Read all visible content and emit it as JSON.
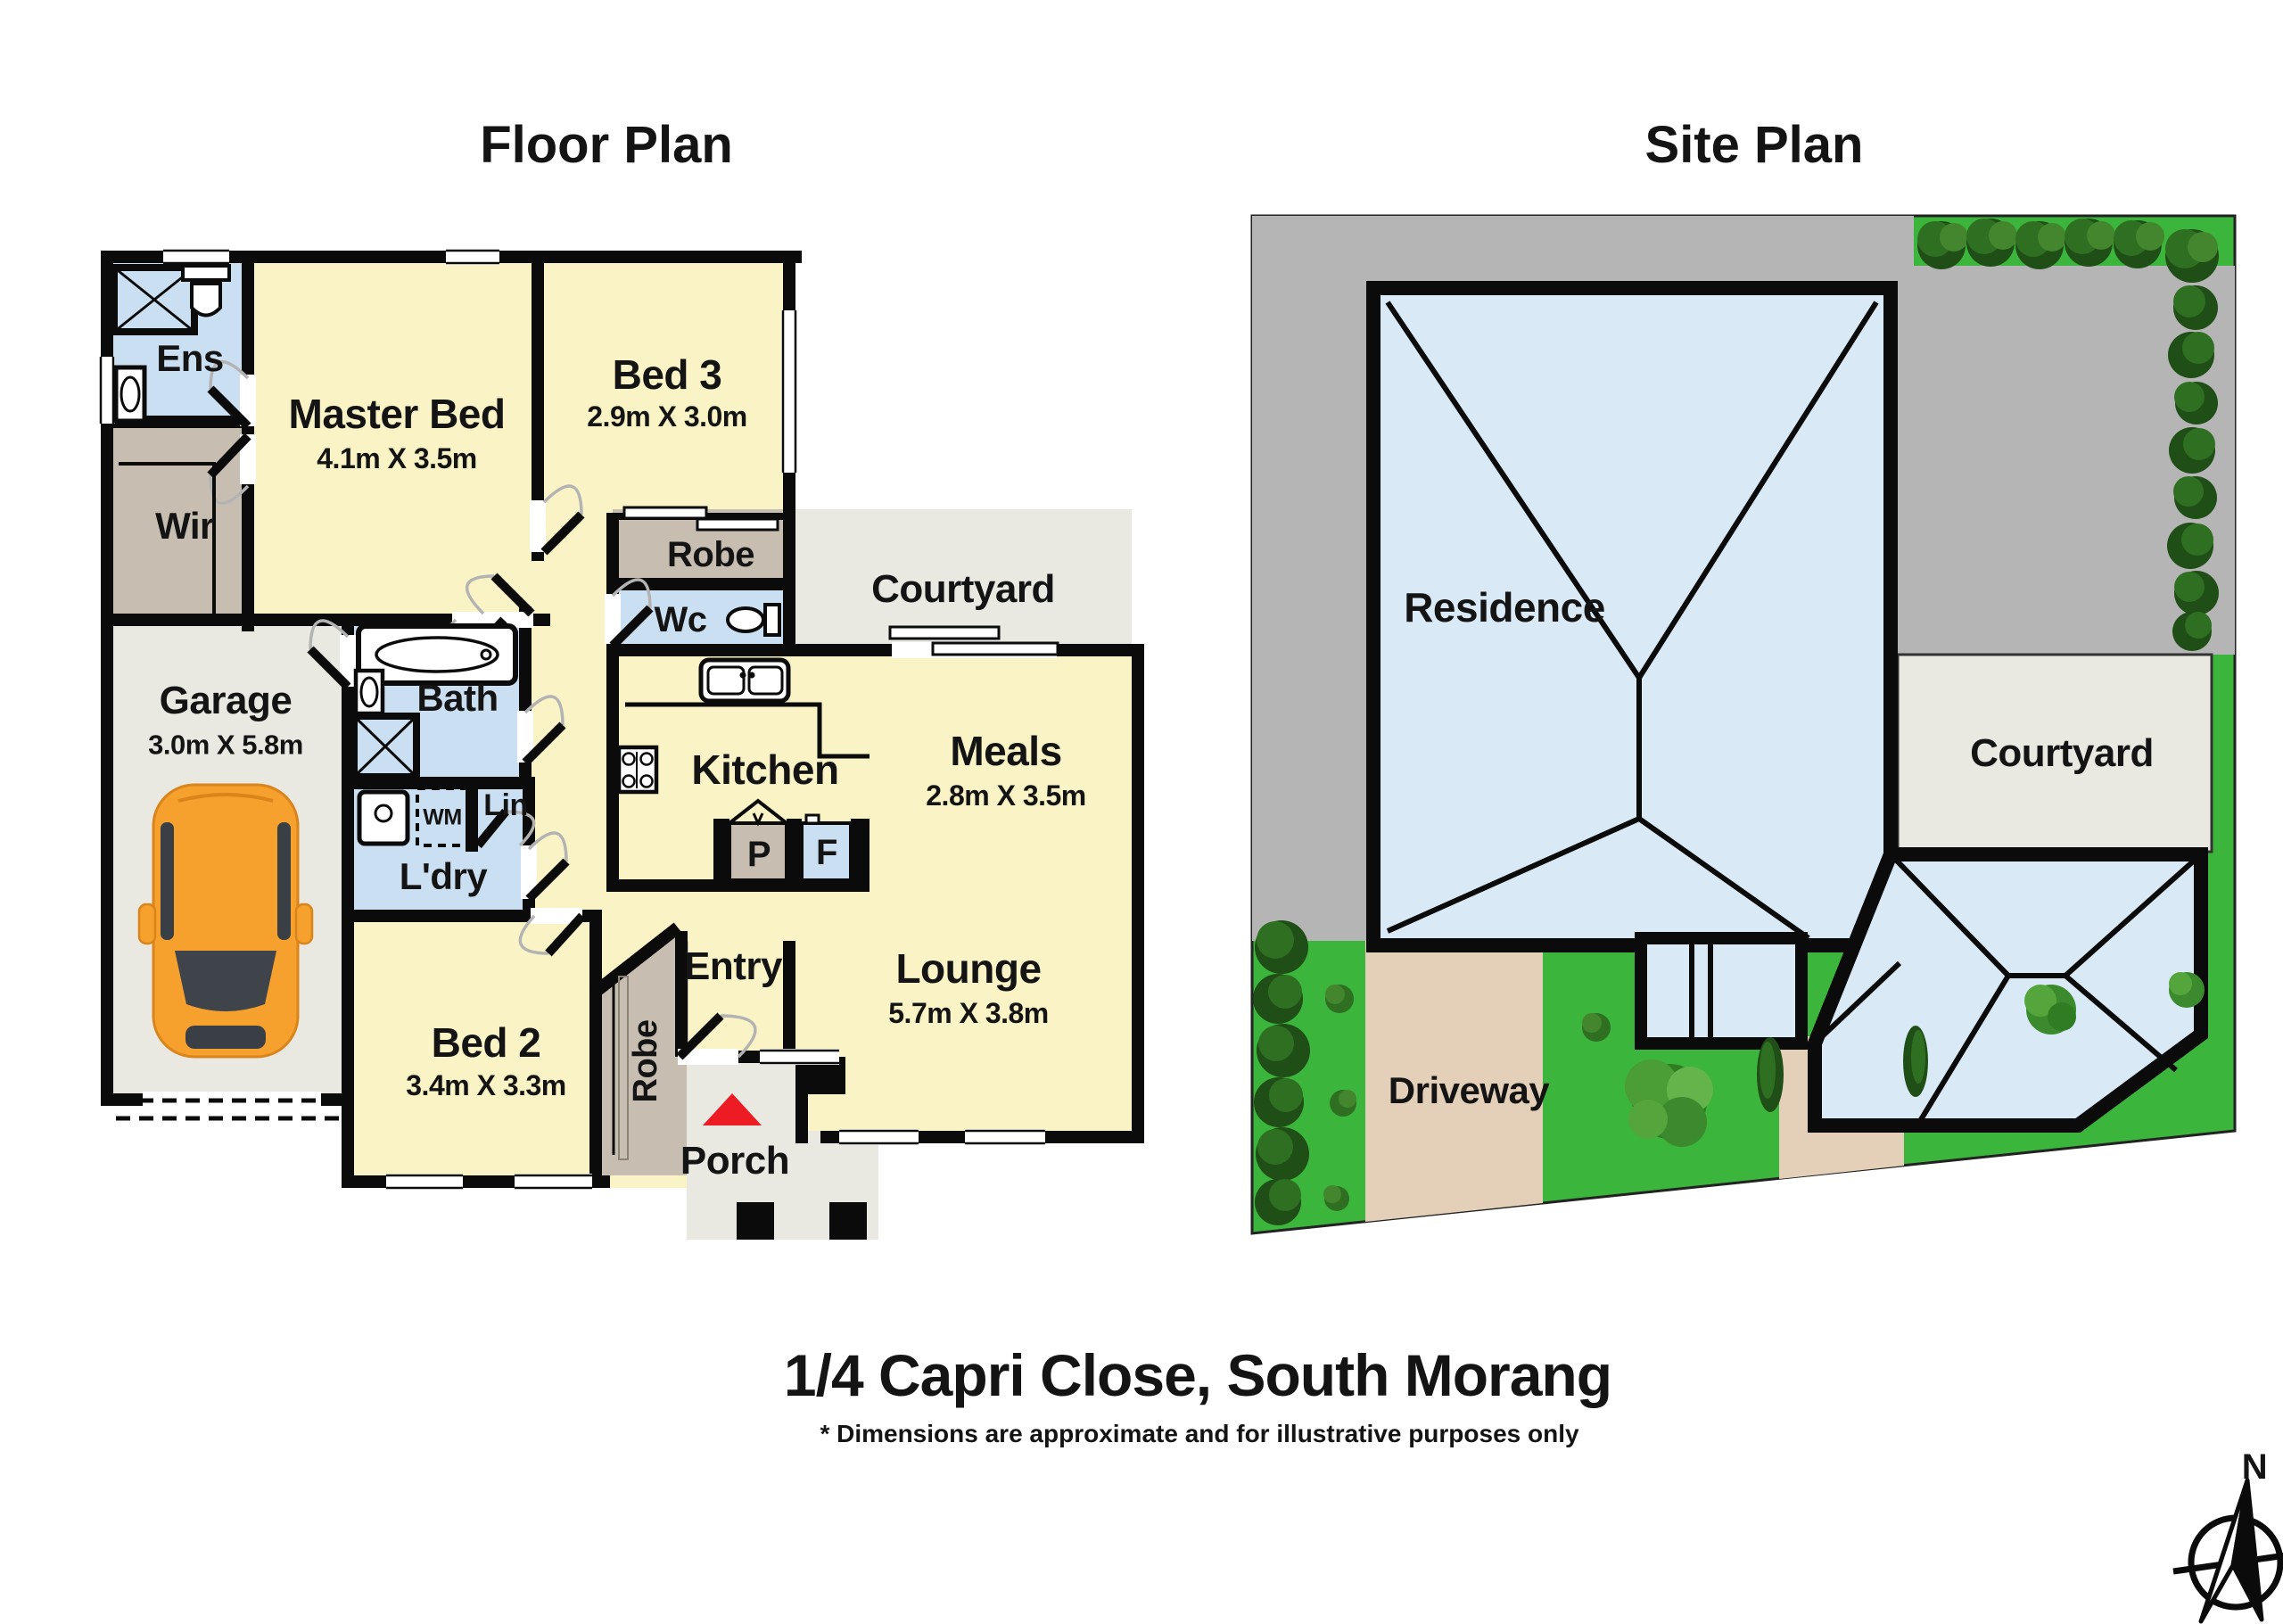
{
  "page": {
    "floor_plan_title": "Floor Plan",
    "site_plan_title": "Site Plan",
    "address_title": "1/4 Capri Close, South Morang",
    "disclaimer": "* Dimensions are approximate and for illustrative purposes only"
  },
  "fp": {
    "ens": {
      "label": "Ens"
    },
    "master": {
      "label": "Master Bed",
      "dims": "4.1m X 3.5m"
    },
    "bed3": {
      "label": "Bed 3",
      "dims": "2.9m X 3.0m"
    },
    "wir": {
      "label": "Wir"
    },
    "garage": {
      "label": "Garage",
      "dims": "3.0m X 5.8m"
    },
    "bath": {
      "label": "Bath"
    },
    "robe_bed3": {
      "label": "Robe"
    },
    "wc": {
      "label": "Wc"
    },
    "courtyard": {
      "label": "Courtyard"
    },
    "kitchen": {
      "label": "Kitchen"
    },
    "meals": {
      "label": "Meals",
      "dims": "2.8m X 3.5m"
    },
    "wm": {
      "label": "WM"
    },
    "lin": {
      "label": "Lin"
    },
    "ldry": {
      "label": "L'dry"
    },
    "pantry": {
      "label": "P"
    },
    "fridge": {
      "label": "F"
    },
    "bed2": {
      "label": "Bed 2",
      "dims": "3.4m X 3.3m"
    },
    "entry": {
      "label": "Entry"
    },
    "robe_bed2": {
      "label": "Robe"
    },
    "lounge": {
      "label": "Lounge",
      "dims": "5.7m X 3.8m"
    },
    "porch": {
      "label": "Porch"
    }
  },
  "sp": {
    "residence": {
      "label": "Residence"
    },
    "courtyard": {
      "label": "Courtyard"
    },
    "driveway": {
      "label": "Driveway"
    },
    "compass": {
      "north": "N"
    }
  },
  "colors": {
    "room_yellow": "#faf3c6",
    "wet_blue": "#cbdff2",
    "robe_tan": "#c7beb1",
    "floor_gray": "#e9e9e2",
    "wall_black": "#0b0b0b",
    "site_gray": "#b5b5b5",
    "site_green": "#3bb53b",
    "roof_blue": "#d9e9f6",
    "driveway_tan": "#e4d0b8",
    "car_orange": "#f6a02d",
    "accent_red": "#ed1c24"
  }
}
